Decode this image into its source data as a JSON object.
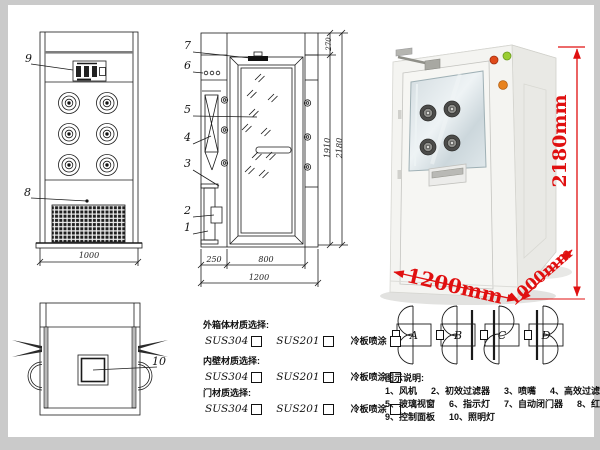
{
  "frame": {
    "color": "#cacaca"
  },
  "palette": {
    "dim_red": "#e01010",
    "line": "#1a1a1a"
  },
  "front_view": {
    "part9": "9",
    "part8": "8",
    "dim_width": "1000"
  },
  "side_view": {
    "part7": "7",
    "part6": "6",
    "part5": "5",
    "part4": "4",
    "part3": "3",
    "part2": "2",
    "part1": "1",
    "dim_left": "250",
    "dim_door": "800",
    "dim_total": "1200",
    "dim_top": "270",
    "dim_door_height": "1910",
    "dim_total_height": "2180"
  },
  "top_view": {
    "part10": "10"
  },
  "photo": {
    "dim_height": "2180mm",
    "dim_width": "1200mm",
    "dim_depth": "1000mm"
  },
  "door_configs": {
    "options": [
      {
        "letter": "A"
      },
      {
        "letter": "B"
      },
      {
        "letter": "C"
      },
      {
        "letter": "D"
      }
    ]
  },
  "materials": {
    "sections": [
      {
        "title": "外箱体材质选择:",
        "options": [
          "SUS304",
          "SUS201",
          "冷板喷涂"
        ]
      },
      {
        "title": "内壁材质选择:",
        "options": [
          "SUS304",
          "SUS201",
          "冷板喷涂"
        ]
      },
      {
        "title": "门材质选择:",
        "options": [
          "SUS304",
          "SUS201",
          "冷板喷涂"
        ]
      }
    ]
  },
  "legend": {
    "title": "图示说明:",
    "items": [
      "1、风机",
      "2、初效过滤器",
      "3、喷嘴",
      "4、高效过滤器",
      "5、玻璃视窗",
      "6、指示灯",
      "7、自动闭门器",
      "8、红外线感应器",
      "9、控制面板",
      "10、照明灯"
    ]
  }
}
